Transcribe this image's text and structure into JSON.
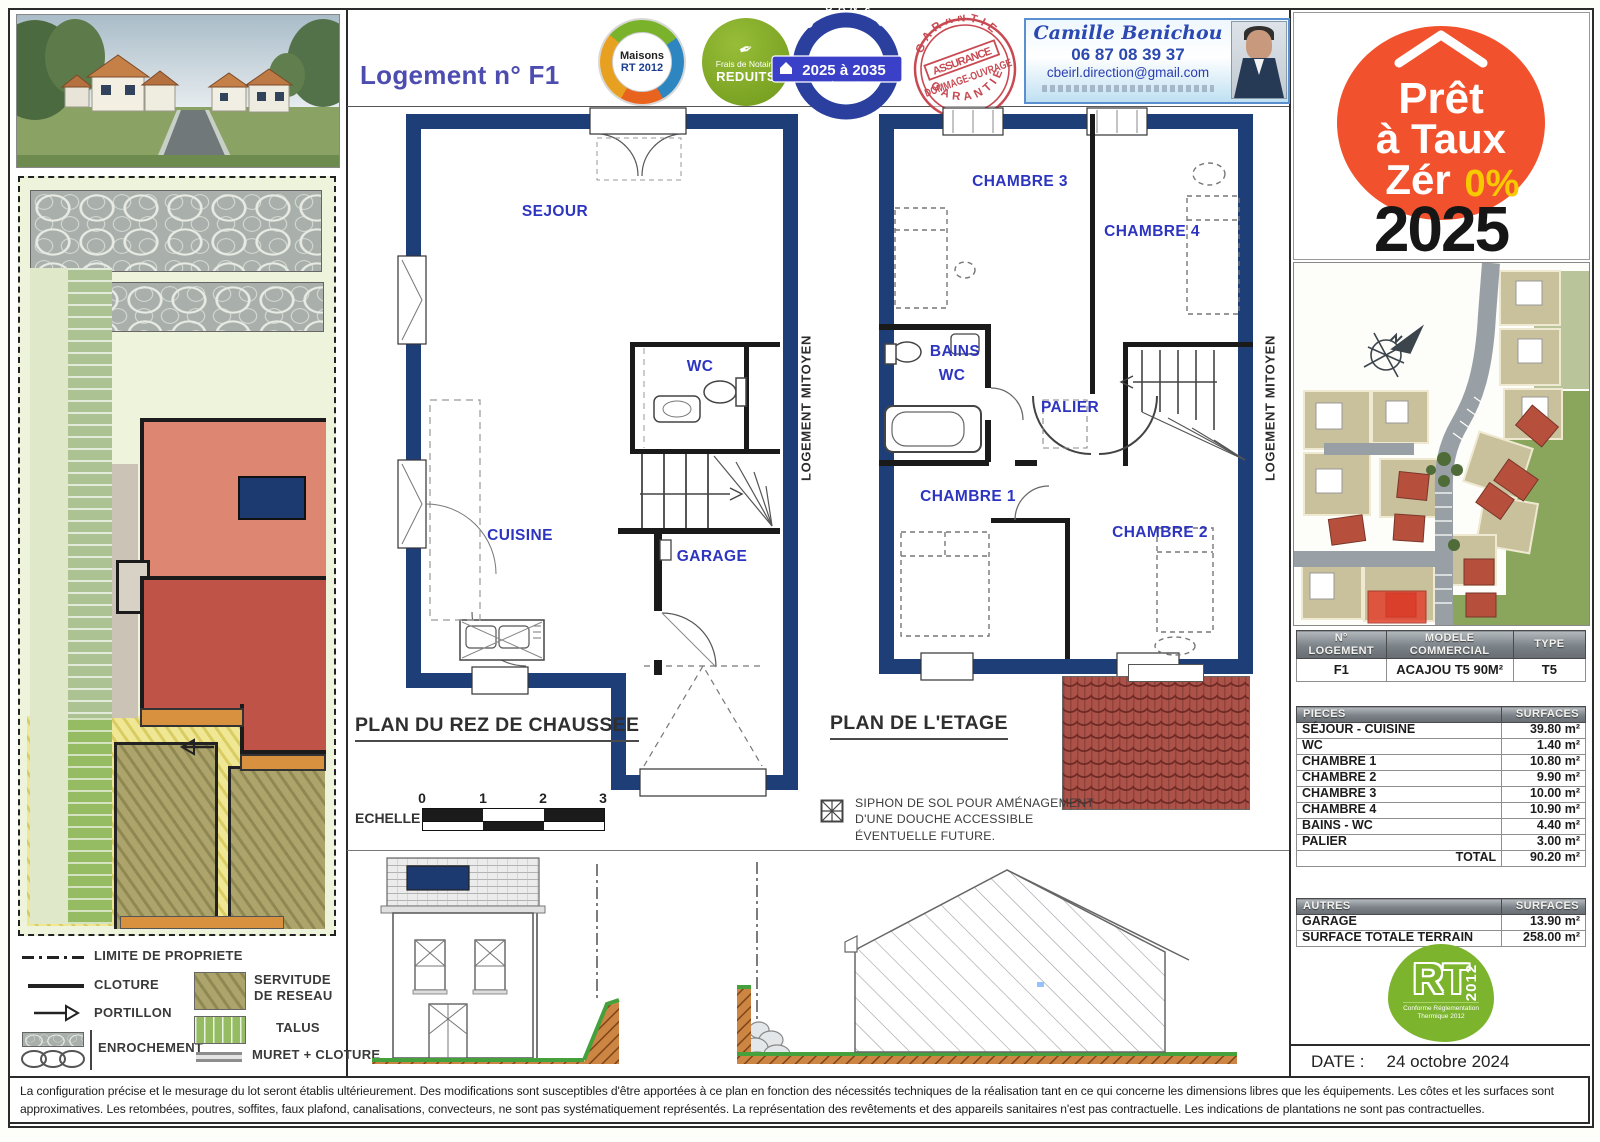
{
  "header": {
    "title": "Logement n° F1",
    "medal": {
      "line1": "Maisons",
      "line2": "RT 2012"
    },
    "notaire": {
      "line1": "Frais de Notaire",
      "line2": "REDUITS"
    },
    "garantie": {
      "arc": "GARANTIE",
      "banner": "2025 à 2035",
      "sub": "décennale"
    },
    "stamp": {
      "arc_top": "GARANTIE",
      "line1": "ASSURANCE",
      "line2": "DOMMAGE-OUVRAGE",
      "arc_bottom": "GARANTIE"
    },
    "contact": {
      "name": "Camille Benichou",
      "phone": "06 87 08 39 37",
      "email": "cbeirl.direction@gmail.com"
    }
  },
  "plans": {
    "ground": {
      "title": "PLAN DU REZ DE CHAUSSEE",
      "rooms": {
        "sejour": "SEJOUR",
        "wc": "WC",
        "cuisine": "CUISINE",
        "garage": "GARAGE"
      },
      "party_wall": "LOGEMENT MITOYEN"
    },
    "etage": {
      "title": "PLAN DE L'ETAGE",
      "rooms": {
        "ch3": "CHAMBRE 3",
        "ch4": "CHAMBRE 4",
        "bains1": "BAINS",
        "bains2": "WC",
        "palier": "PALIER",
        "ch1": "CHAMBRE 1",
        "ch2": "CHAMBRE 2"
      },
      "party_wall": "LOGEMENT MITOYEN"
    },
    "echelle_label": "ECHELLE :",
    "ticks": [
      "0",
      "1",
      "2",
      "3"
    ],
    "siphon_line1": "SIPHON DE SOL POUR AMÉNAGEMENT",
    "siphon_line2": "D'UNE DOUCHE ACCESSIBLE",
    "siphon_line3": "ÉVENTUELLE  FUTURE."
  },
  "legend": {
    "items": [
      {
        "label": "LIMITE DE PROPRIETE"
      },
      {
        "label": "CLOTURE"
      },
      {
        "label": "PORTILLON"
      },
      {
        "label": "ENROCHEMENT"
      },
      {
        "label": "SERVITUDE DE RESEAU"
      },
      {
        "label": "TALUS"
      },
      {
        "label": "MURET + CLOTURE"
      }
    ]
  },
  "right": {
    "ptz": {
      "word1": "Prêt",
      "word2": "à Taux",
      "word3": "Zér",
      "pct": "0%",
      "year": "2025"
    },
    "logement_table": {
      "h1a": "N°",
      "h1b": "LOGEMENT",
      "h2a": "MODELE",
      "h2b": "COMMERCIAL",
      "h3": "TYPE",
      "rows": [
        [
          "F1",
          "ACAJOU T5 90M²",
          "T5"
        ]
      ]
    },
    "surfaces_table": {
      "headers": [
        "PIECES",
        "SURFACES"
      ],
      "rows": [
        [
          "SÉJOUR - CUISINE",
          "39.80 m²"
        ],
        [
          "WC",
          "1.40 m²"
        ],
        [
          "CHAMBRE 1",
          "10.80 m²"
        ],
        [
          "CHAMBRE 2",
          "9.90 m²"
        ],
        [
          "CHAMBRE 3",
          "10.00 m²"
        ],
        [
          "CHAMBRE 4",
          "10.90 m²"
        ],
        [
          "BAINS - WC",
          "4.40 m²"
        ],
        [
          "PALIER",
          "3.00 m²"
        ]
      ],
      "total_label": "TOTAL",
      "total_value": "90.20 m²"
    },
    "autres_table": {
      "headers": [
        "AUTRES",
        "SURFACES"
      ],
      "rows": [
        [
          "GARAGE",
          "13.90 m²"
        ],
        [
          "SURFACE TOTALE TERRAIN",
          "258.00 m²"
        ]
      ]
    },
    "rt": {
      "rt": "RT",
      "year": "2012",
      "sub1": "Conforme Réglementation",
      "sub2": "Thermique 2012"
    },
    "date_label": "DATE :",
    "date_value": "24 octobre 2024"
  },
  "footer": {
    "disclaimer": "La configuration précise et le mesurage du lot seront établis ultérieurement. Des modifications sont susceptibles d'être apportées à ce plan en fonction des nécessités techniques de la réalisation tant en ce qui concerne les dimensions libres que les équipements. Les côtes et les surfaces sont approximatives. Les retombées, poutres, soffites, faux plafond, canalisations, convecteurs, ne sont pas systématiquement représentés. La représentation des revêtements et des appareils sanitaires n'est pas contractuelle. Les indications de plantations ne sont pas contractuelles."
  },
  "colors": {
    "wall_navy": "#1e3e78",
    "room_label_blue": "#2d35c0",
    "ptz_orange": "#f1522d",
    "ptz_yellow": "#f7c900",
    "rt_green": "#7cb42e",
    "stamp_red": "#c43a44",
    "tile_red": "#ad5249"
  }
}
